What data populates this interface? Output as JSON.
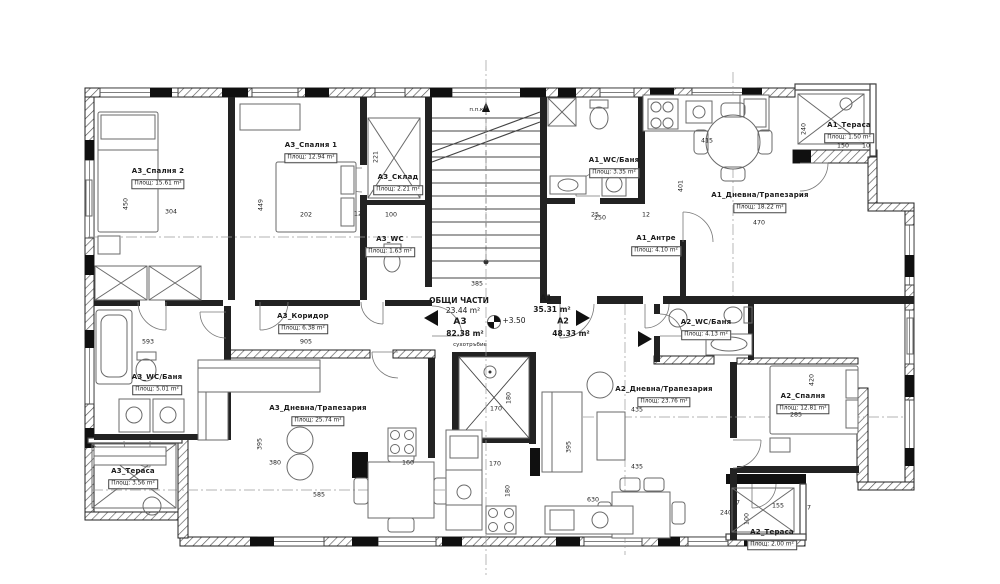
{
  "plan": {
    "common": {
      "name": "ОБЩИ ЧАСТИ",
      "area": "23.44 m²",
      "elevation": "+3.50",
      "dry_riser": "сухотръбие",
      "fire_cabinet": "п.п.кл."
    },
    "apartments": [
      {
        "id": "А3",
        "total": "82.38 m²"
      },
      {
        "id": "А1",
        "total": "35.31 m²"
      },
      {
        "id": "А2",
        "total": "48.33 m²"
      }
    ],
    "rooms": [
      {
        "name": "А3_Спалня 2",
        "area": "Площ: 15.61 m²",
        "x": 158,
        "y": 172
      },
      {
        "name": "А3_Спалня 1",
        "area": "Площ: 12.94 m²",
        "x": 311,
        "y": 146
      },
      {
        "name": "А3_Склад",
        "area": "Площ: 2.21 m²",
        "x": 398,
        "y": 178
      },
      {
        "name": "А3_WC",
        "area": "Площ: 1.63 m²",
        "x": 390,
        "y": 240
      },
      {
        "name": "А3_Коридор",
        "area": "Площ: 6.38 m²",
        "x": 303,
        "y": 317
      },
      {
        "name": "А3_WC/Баня",
        "area": "Площ: 5.01 m²",
        "x": 157,
        "y": 378
      },
      {
        "name": "А3_Дневна/Трапезария",
        "area": "Площ: 25.74 m²",
        "x": 318,
        "y": 409
      },
      {
        "name": "А3_Тераса",
        "area": "Площ: 3.56 m²",
        "x": 133,
        "y": 472
      },
      {
        "name": "А1_WC/Баня",
        "area": "Площ: 3.35 m²",
        "x": 614,
        "y": 161
      },
      {
        "name": "А1_Антре",
        "area": "Площ: 4.10 m²",
        "x": 656,
        "y": 239
      },
      {
        "name": "А1_Дневна/Трапезария",
        "area": "Площ: 18.22 m²",
        "x": 760,
        "y": 196
      },
      {
        "name": "А1_Тераса",
        "area": "Площ: 1.50 m²",
        "x": 849,
        "y": 126
      },
      {
        "name": "А2_WC/Баня",
        "area": "Площ: 4.13 m²",
        "x": 706,
        "y": 323
      },
      {
        "name": "А2_Спалня",
        "area": "Площ: 12.81 m²",
        "x": 803,
        "y": 397
      },
      {
        "name": "А2_Дневна/Трапезария",
        "area": "Площ: 23.76 m²",
        "x": 664,
        "y": 390
      },
      {
        "name": "А2_Тераса",
        "area": "Площ: 2.00 m²",
        "x": 772,
        "y": 533
      }
    ],
    "dims": [
      {
        "t": "304",
        "x": 171,
        "y": 213
      },
      {
        "t": "450",
        "x": 127,
        "y": 204,
        "v": 1
      },
      {
        "t": "202",
        "x": 306,
        "y": 216
      },
      {
        "t": "449",
        "x": 262,
        "y": 205,
        "v": 1
      },
      {
        "t": "221",
        "x": 377,
        "y": 157,
        "v": 1
      },
      {
        "t": "100",
        "x": 391,
        "y": 216
      },
      {
        "t": "12",
        "x": 358,
        "y": 215
      },
      {
        "t": "250",
        "x": 600,
        "y": 219
      },
      {
        "t": "12",
        "x": 646,
        "y": 216
      },
      {
        "t": "25",
        "x": 595,
        "y": 216
      },
      {
        "t": "415",
        "x": 707,
        "y": 142
      },
      {
        "t": "401",
        "x": 682,
        "y": 186,
        "v": 1
      },
      {
        "t": "470",
        "x": 759,
        "y": 224
      },
      {
        "t": "150",
        "x": 843,
        "y": 147
      },
      {
        "t": "10",
        "x": 866,
        "y": 147
      },
      {
        "t": "240",
        "x": 805,
        "y": 129,
        "v": 1
      },
      {
        "t": "593",
        "x": 148,
        "y": 343
      },
      {
        "t": "905",
        "x": 306,
        "y": 343
      },
      {
        "t": "385",
        "x": 477,
        "y": 285
      },
      {
        "t": "395",
        "x": 261,
        "y": 444,
        "v": 1
      },
      {
        "t": "380",
        "x": 275,
        "y": 464
      },
      {
        "t": "585",
        "x": 319,
        "y": 496
      },
      {
        "t": "160",
        "x": 408,
        "y": 464
      },
      {
        "t": "170",
        "x": 496,
        "y": 410
      },
      {
        "t": "180",
        "x": 510,
        "y": 398,
        "v": 1
      },
      {
        "t": "170",
        "x": 495,
        "y": 465
      },
      {
        "t": "180",
        "x": 509,
        "y": 491,
        "v": 1
      },
      {
        "t": "395",
        "x": 570,
        "y": 447,
        "v": 1
      },
      {
        "t": "435",
        "x": 637,
        "y": 411
      },
      {
        "t": "435",
        "x": 637,
        "y": 468
      },
      {
        "t": "630",
        "x": 593,
        "y": 501
      },
      {
        "t": "285",
        "x": 796,
        "y": 416
      },
      {
        "t": "420",
        "x": 813,
        "y": 380,
        "v": 1
      },
      {
        "t": "155",
        "x": 778,
        "y": 507
      },
      {
        "t": "7",
        "x": 809,
        "y": 509
      },
      {
        "t": "100",
        "x": 748,
        "y": 519,
        "v": 1
      },
      {
        "t": "37",
        "x": 736,
        "y": 504
      },
      {
        "t": "240",
        "x": 726,
        "y": 514
      }
    ]
  }
}
